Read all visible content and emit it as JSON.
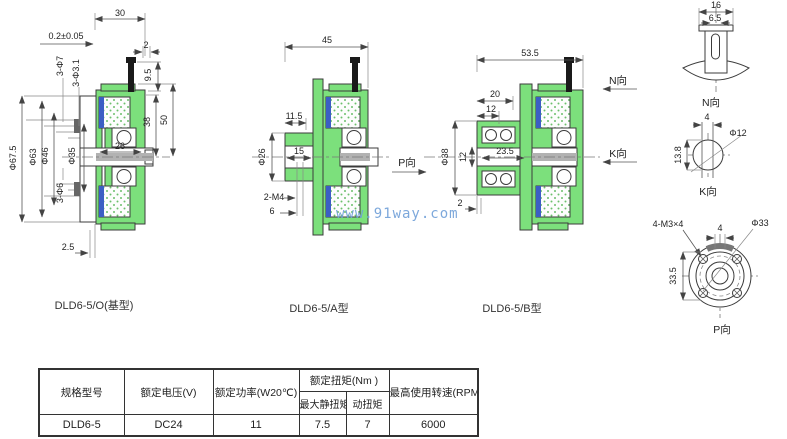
{
  "watermark": "www.91way.com",
  "colors": {
    "body_green": "#7ce07c",
    "coil_blue": "#3c5ec4",
    "watermark_blue": "#6f9fd8",
    "line": "#3b3b3b"
  },
  "views": {
    "base": {
      "caption": "DLD6-5/O(基型)",
      "dims": {
        "width": "30",
        "tolerance": "0.2±0.05",
        "lip": "2",
        "holes_7": "3-Φ7",
        "holes_31": "3-Φ3.1",
        "h95": "9.5",
        "h38": "38",
        "h50": "50",
        "od": "Φ67.5",
        "d63": "Φ63",
        "d46": "Φ46",
        "d35": "Φ35",
        "w26": "26",
        "holes_6": "3-Φ6",
        "offset": "2.5"
      }
    },
    "a_type": {
      "caption": "DLD6-5/A型",
      "direction": "P向",
      "dims": {
        "width": "45",
        "hub": "11.5",
        "hub_od": "Φ26",
        "bore": "15",
        "tap": "2-M4",
        "depth": "6"
      }
    },
    "b_type": {
      "caption": "DLD6-5/B型",
      "dir_n": "N向",
      "dir_k": "K向",
      "dims": {
        "width": "53.5",
        "d20": "20",
        "d12": "12",
        "hub_od": "Φ38",
        "bore12": "12",
        "len": "23.5",
        "lip": "2"
      }
    }
  },
  "details": {
    "n_view": {
      "label": "N向",
      "dims": {
        "w": "16",
        "slot": "6.5"
      }
    },
    "k_view": {
      "label": "K向",
      "dims": {
        "w": "4",
        "dia": "Φ12",
        "h": "13.8"
      }
    },
    "p_view": {
      "label": "P向",
      "dims": {
        "screws": "4-M3×4",
        "dia": "Φ33",
        "slot": "4",
        "pitch": "33.5"
      }
    }
  },
  "table": {
    "headers": {
      "model": "规格型号",
      "voltage": "额定电压(V)",
      "power": "额定功率(W20℃)",
      "torque_group": "额定扭矩(Nm )",
      "static_torque": "最大静扭矩",
      "dynamic_torque": "动扭矩",
      "speed": "最高使用转速(RPM)"
    },
    "row": {
      "model": "DLD6-5",
      "voltage": "DC24",
      "power": "11",
      "static_torque": "7.5",
      "dynamic_torque": "7",
      "speed": "6000"
    }
  }
}
